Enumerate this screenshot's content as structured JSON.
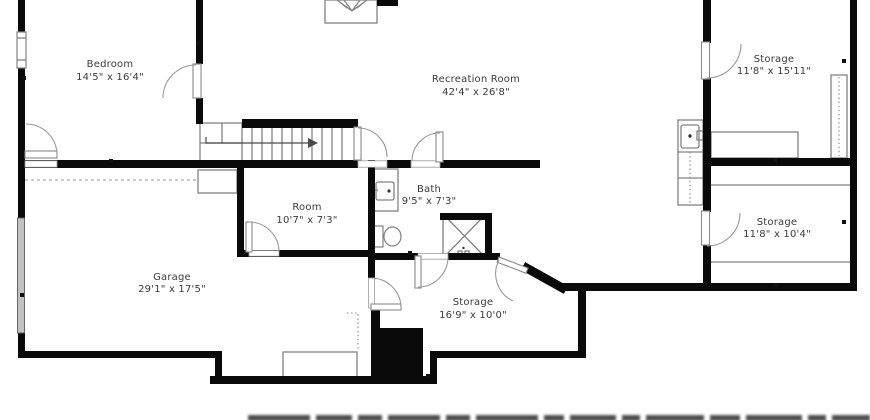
{
  "plan": {
    "type": "basement-floor-plan",
    "rooms": [
      {
        "id": "bedroom",
        "name": "Bedroom",
        "dims": "14'5\" x 16'4\""
      },
      {
        "id": "recreation-room",
        "name": "Recreation Room",
        "dims": "42'4\" x 26'8\""
      },
      {
        "id": "storage-top-right",
        "name": "Storage",
        "dims": "11'8\" x 15'11\""
      },
      {
        "id": "room",
        "name": "Room",
        "dims": "10'7\" x 7'3\""
      },
      {
        "id": "bath",
        "name": "Bath",
        "dims": "9'5\" x 7'3\""
      },
      {
        "id": "garage",
        "name": "Garage",
        "dims": "29'1\" x 17'5\""
      },
      {
        "id": "storage-center",
        "name": "Storage",
        "dims": "16'9\" x 10'0\""
      },
      {
        "id": "storage-bottom-right",
        "name": "Storage",
        "dims": "11'8\" x 10'4\""
      }
    ],
    "colors": {
      "wall": "#0a0a0a",
      "fixture_line": "#828282",
      "label_text": "#3b3b3b",
      "garage_door_fill": "#c2c2c2"
    }
  }
}
